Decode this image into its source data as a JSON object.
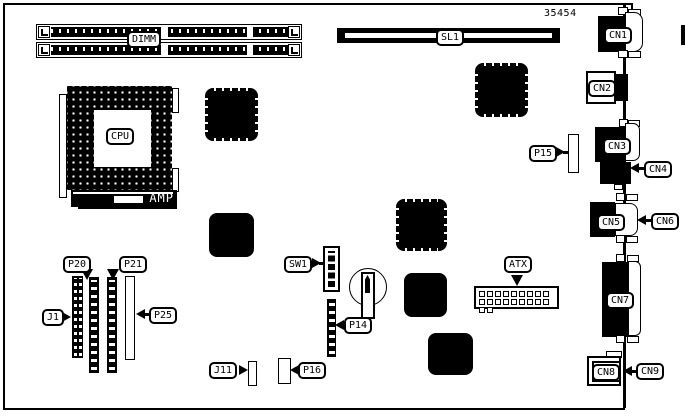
{
  "figure": {
    "part_number": "35454",
    "colors": {
      "ink": "#000000",
      "paper": "#ffffff"
    }
  },
  "components": {
    "memory": {
      "label": "DIMM"
    },
    "slot": {
      "label": "SL1"
    },
    "processor": {
      "label": "CPU"
    },
    "amplifier": {
      "label": "AMP"
    },
    "dip_switch": {
      "label": "SW1"
    },
    "power_connector": {
      "label": "ATX"
    },
    "headers": {
      "j1": "J1",
      "j11": "J11",
      "p14": "P14",
      "p15": "P15",
      "p16": "P16",
      "p20": "P20",
      "p21": "P21",
      "p25": "P25"
    },
    "rear_connectors": {
      "cn1": "CN1",
      "cn2": "CN2",
      "cn3": "CN3",
      "cn4": "CN4",
      "cn5": "CN5",
      "cn6": "CN6",
      "cn7": "CN7",
      "cn8": "CN8",
      "cn9": "CN9"
    }
  }
}
